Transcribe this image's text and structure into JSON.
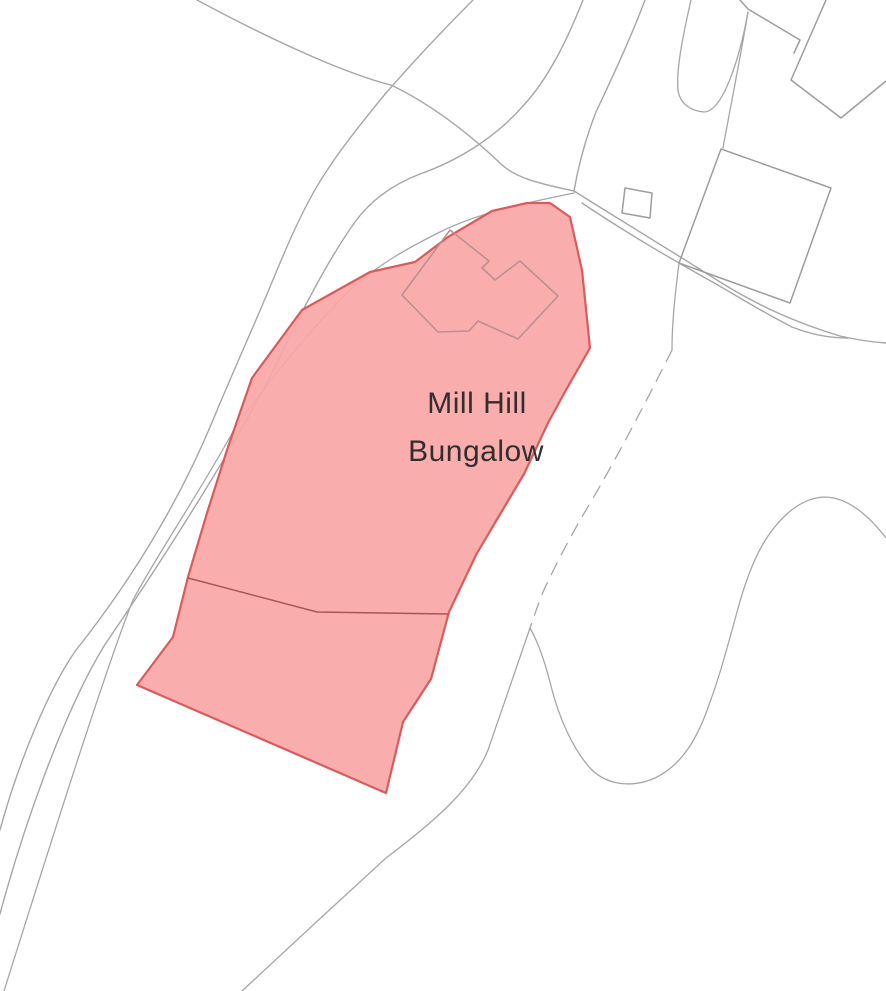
{
  "map": {
    "width": 886,
    "height": 991,
    "background": "#ffffff",
    "label_color": "#332d2d",
    "colors": {
      "site_fill": "#f8a6a6",
      "site_stroke": "#d95c5c",
      "map_line_gray": "#a6a6a6",
      "building_line_gray": "#9d9d9d",
      "footprint_stroke": "#bf8e92",
      "internal_boundary": "#a65858"
    },
    "labels": [
      {
        "id": "site-label-mill-hill",
        "text": "Mill Hill",
        "x": 477,
        "y": 413,
        "font_size": 30
      },
      {
        "id": "site-label-bungalow",
        "text": "Bungalow",
        "x": 476,
        "y": 461,
        "font_size": 30
      }
    ],
    "features": [
      {
        "id": "road-west-outer-edge",
        "d": "M473,0 C445,28 413,62 386,93 C362,122 341,149 328,169 C306,201 288,243 270,287 C252,330 232,374 213,420 C178,505 128,585 76,650 C48,690 18,764 0,830",
        "stroke": "map_line_gray",
        "stroke_width": 1.4
      },
      {
        "id": "road-west-middle-edge",
        "d": "M583,0 C568,38 549,78 523,106 C495,138 457,161 420,174 C394,184 371,200 355,222 C329,258 299,316 277,363 C249,420 189,521 104,646 C62,715 22,832 0,914",
        "stroke": "map_line_gray",
        "stroke_width": 1.4
      },
      {
        "id": "fence-line-northwest-of-site",
        "d": "M574,193 C530,202 480,212 440,232 C410,247 380,263 350,290 C310,330 268,382 235,428 C200,492 155,558 133,600 C105,670 46,858 4,991",
        "stroke": "map_line_gray",
        "stroke_width": 1.3
      },
      {
        "id": "road-northwest-edge",
        "d": "M197,0 C262,35 342,73 391,85 C437,107 477,141 501,164 C517,179 542,184 574,191",
        "stroke": "map_line_gray",
        "stroke_width": 1.4
      },
      {
        "id": "road-north-edge",
        "d": "M645,0 C630,40 611,80 596,112 C585,140 578,168 574,191",
        "stroke": "map_line_gray",
        "stroke_width": 1.4
      },
      {
        "id": "driveway-hairpin",
        "d": "M691,0 C683,35 676,70 678,90 C680,104 691,111 704,112 C722,112 739,62 748,12",
        "stroke": "map_line_gray",
        "stroke_width": 1.3
      },
      {
        "id": "building-connector-line",
        "d": "M748,12 C740,60 729,114 723,148",
        "stroke": "map_line_gray",
        "stroke_width": 1.3
      },
      {
        "id": "road-east-upper-edge",
        "d": "M574,191 C620,220 670,250 720,282 C762,308 800,324 840,336 C857,340 872,342 886,343",
        "stroke": "map_line_gray",
        "stroke_width": 1.4
      },
      {
        "id": "road-east-lower-edge",
        "d": "M582,203 C622,230 661,253 700,275 C731,292 762,312 792,327 C812,335 830,338 848,338",
        "stroke": "map_line_gray",
        "stroke_width": 1.4
      },
      {
        "id": "building-outline-top-right-main",
        "d": "M826,0 L791,80 L841,118 L886,81",
        "stroke": "building_line_gray",
        "stroke_width": 1.5
      },
      {
        "id": "building-outline-top-right-wing",
        "d": "M740,0 L748,9 L800,40 L794,53",
        "stroke": "building_line_gray",
        "stroke_width": 1.5
      },
      {
        "id": "building-outline-east",
        "d": "M721,149 L831,188 L790,303 L679,263 Z",
        "stroke": "building_line_gray",
        "stroke_width": 1.5
      },
      {
        "id": "boundary-solid-upper",
        "d": "M679,263 C675,295 672,322 672,350",
        "stroke": "map_line_gray",
        "stroke_width": 1.3
      },
      {
        "id": "boundary-dashed",
        "d": "M672,350 C651,392 615,462 586,510 C570,537 553,570 543,592 C538,605 534,616 530,628",
        "stroke": "map_line_gray",
        "stroke_width": 1.3,
        "dash": "13 9"
      },
      {
        "id": "boundary-solid-lower",
        "d": "M530,628 C518,662 502,710 488,750 C472,790 431,824 386,858 C339,901 288,948 242,991",
        "stroke": "map_line_gray",
        "stroke_width": 1.3
      },
      {
        "id": "field-enclosure-curve",
        "d": "M886,538 C866,512 845,497 824,497 C803,498 784,513 768,536 C755,555 745,582 737,612 C728,645 719,678 710,702 C698,738 682,765 655,778 C630,789 605,784 590,768 C573,749 559,718 551,686 C545,662 538,642 530,628",
        "stroke": "map_line_gray",
        "stroke_width": 1.3
      },
      {
        "id": "outbuilding-square",
        "d": "M625,188 L652,193 L650,218 L622,213 Z",
        "stroke": "building_line_gray",
        "stroke_width": 1.5
      },
      {
        "id": "site-boundary-highlight",
        "d": "M570,217 L582,270 L590,348 L566,390 L548,423 L524,474 L499,516 L476,555 L449,612 L431,679 L403,722 L386,793 L137,685 L173,637 L188,577 L207,513 L227,450 L252,378 L302,310 L370,272 L415,262 L448,237 L492,211 L527,203 L550,203 Z",
        "stroke": "site_stroke",
        "stroke_width": 2.2,
        "fill": "site_fill",
        "fill_opacity": 0.92
      },
      {
        "id": "bungalow-footprint-outline",
        "d": "M450,230 L489,261 L482,268 L495,280 L520,261 L558,296 L518,339 L478,321 L469,331 L438,332 L402,295 Z",
        "stroke": "footprint_stroke",
        "stroke_width": 1.6
      },
      {
        "id": "site-internal-boundary",
        "d": "M188,578 L317,612 L448,614",
        "stroke": "internal_boundary",
        "stroke_width": 1.5
      }
    ]
  }
}
